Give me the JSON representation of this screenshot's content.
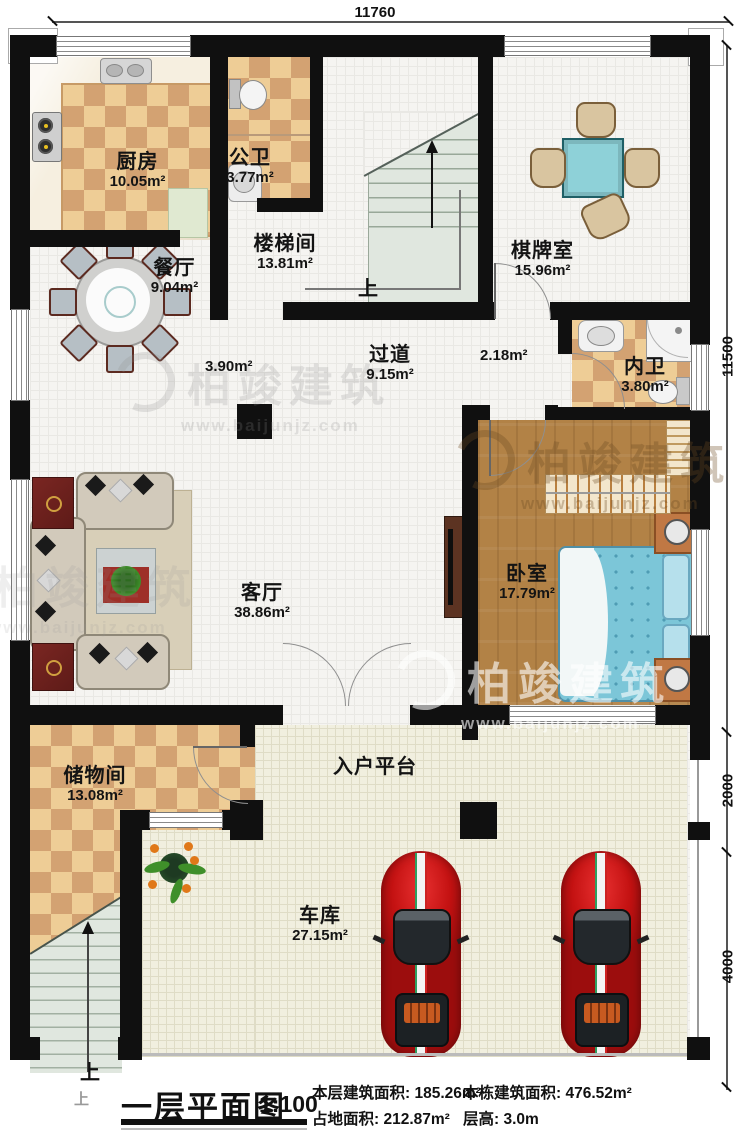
{
  "dimensions": {
    "top": "11760",
    "right": [
      "11500",
      "2000",
      "4000"
    ]
  },
  "rooms": [
    {
      "id": "kitchen",
      "name": "厨房",
      "area": "10.05m²"
    },
    {
      "id": "public-bath",
      "name": "公卫",
      "area": "3.77m²"
    },
    {
      "id": "stairwell",
      "name": "楼梯间",
      "area": "13.81m²"
    },
    {
      "id": "game-room",
      "name": "棋牌室",
      "area": "15.96m²"
    },
    {
      "id": "dining",
      "name": "餐厅",
      "area": "9.04m²"
    },
    {
      "id": "corridor",
      "name": "过道",
      "area": "9.15m²"
    },
    {
      "id": "inner-bath",
      "name": "内卫",
      "area": "3.80m²"
    },
    {
      "id": "bedroom",
      "name": "卧室",
      "area": "17.79m²"
    },
    {
      "id": "living",
      "name": "客厅",
      "area": "38.86m²"
    },
    {
      "id": "storage",
      "name": "储物间",
      "area": "13.08m²"
    },
    {
      "id": "entry-platform",
      "name": "入户平台",
      "area": ""
    },
    {
      "id": "garage",
      "name": "车库",
      "area": "27.15m²"
    }
  ],
  "measurements": {
    "corridor_left": "3.90m²",
    "corridor_right": "2.18m²"
  },
  "stairs": {
    "up_inner": "上",
    "up_outer": "上",
    "up_outer_faint": "上"
  },
  "watermark": {
    "brand": "柏竣建筑",
    "url": "www.baijunjz.com"
  },
  "footer": {
    "title": "一层平面图",
    "scale": "1:100",
    "stats": [
      {
        "label": "本层建筑面积:",
        "value": "185.26m²"
      },
      {
        "label": "占地面积:",
        "value": "212.87m²"
      },
      {
        "label": "本栋建筑面积:",
        "value": "476.52m²"
      },
      {
        "label": "层高:",
        "value": "3.0m"
      }
    ]
  },
  "colors": {
    "wall": "#101010",
    "checker_light": "#eecd96",
    "checker_dark": "#d3a272",
    "wood": "#b28246",
    "bed": "#7cc6d8",
    "game_table": "#8ed1d8",
    "car": "#c41212",
    "garage_floor": "#f1efdf",
    "stair": "#e0e7df"
  }
}
